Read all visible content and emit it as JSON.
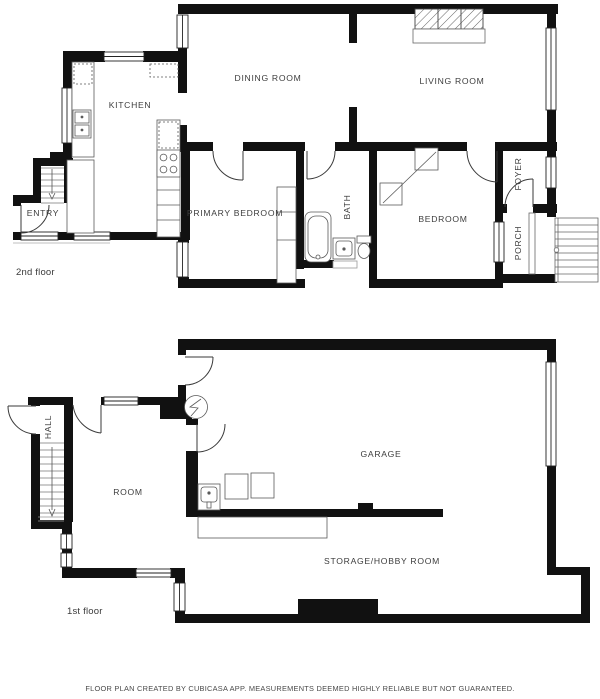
{
  "document": {
    "type": "floor-plan",
    "footer_disclaimer": "FLOOR PLAN CREATED BY CUBICASA APP. MEASUREMENTS DEEMED HIGHLY RELIABLE BUT NOT GUARANTEED."
  },
  "second_floor": {
    "label": "2nd floor",
    "rooms": {
      "kitchen": "KITCHEN",
      "dining_room": "DINING ROOM",
      "living_room": "LIVING ROOM",
      "primary_bedroom": "PRIMARY BEDROOM",
      "bath": "BATH",
      "bedroom": "BEDROOM",
      "entry": "ENTRY",
      "foyer": "FOYER",
      "porch": "PORCH"
    }
  },
  "first_floor": {
    "label": "1st floor",
    "rooms": {
      "hall": "HALL",
      "room": "ROOM",
      "garage": "GARAGE",
      "storage_hobby_room": "STORAGE/HOBBY ROOM"
    }
  },
  "colors": {
    "wall": "#111111",
    "fixture_line": "#5a5a5a",
    "label_text": "#3d3d3d"
  }
}
